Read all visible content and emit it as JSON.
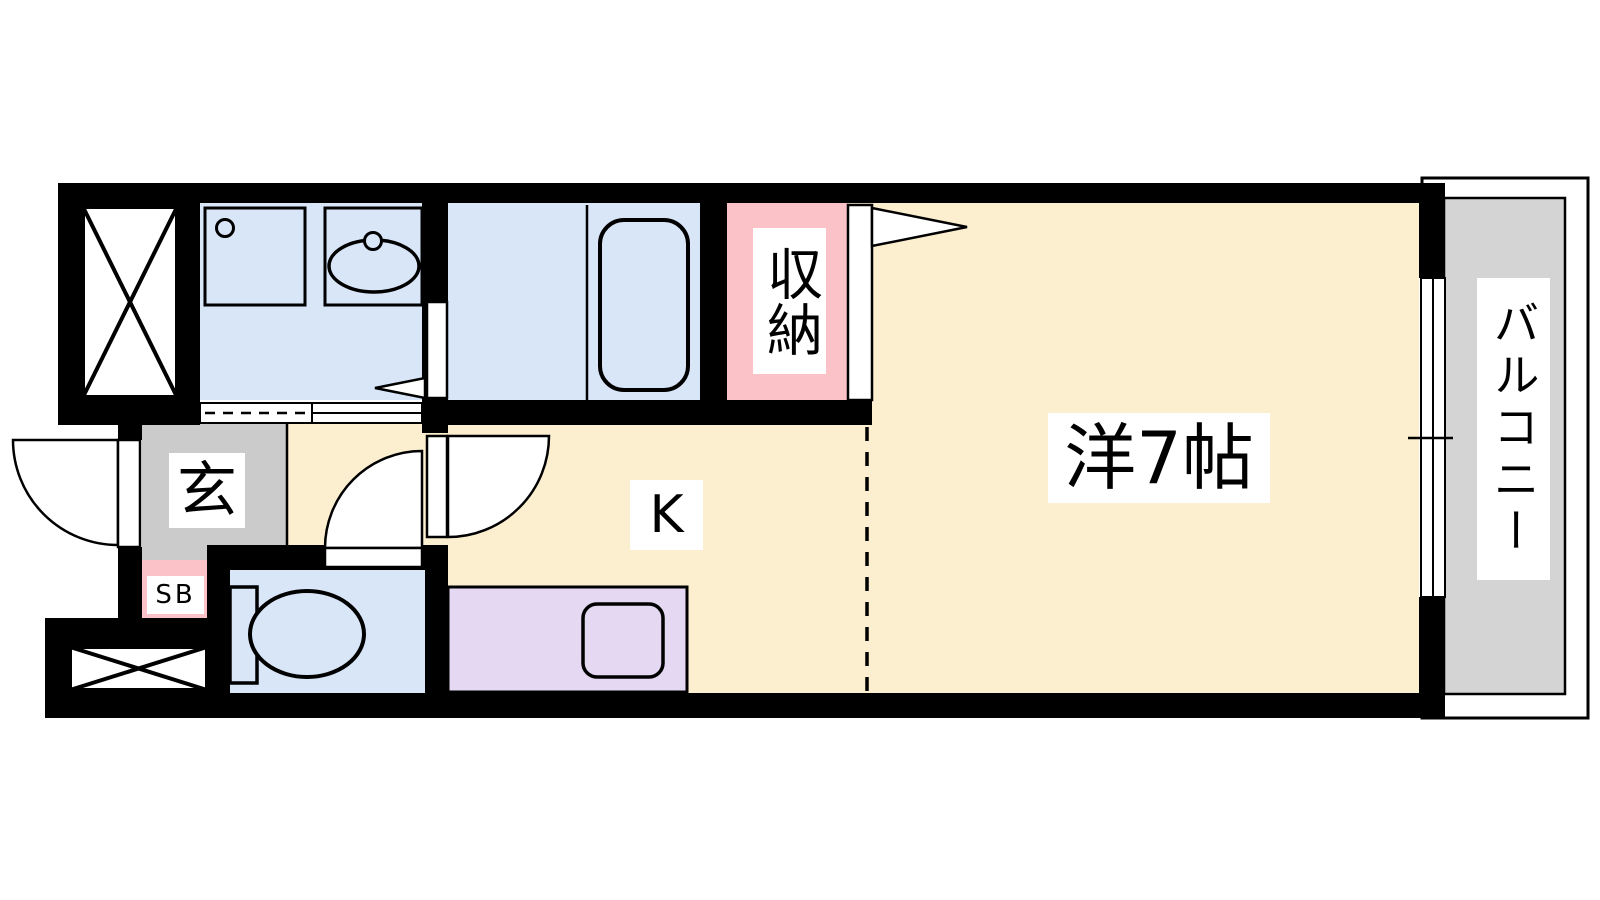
{
  "plan": {
    "title": "1K apartment floor plan",
    "rooms": {
      "western_room": "洋7帖",
      "kitchen": "K",
      "closet": "収納",
      "balcony": "バルコニー",
      "entrance": "玄",
      "shoe_box": "SB"
    },
    "colors": {
      "floor_cream": "#FCEFCF",
      "wet_area_blue": "#D9E6F8",
      "closet_pink": "#FBC2C7",
      "kitchen_purple": "#E5D8F2",
      "entrance_gray": "#CBCBCB",
      "balcony_gray": "#D4D4D4",
      "wall_black": "#000000",
      "line_black": "#000000"
    }
  }
}
